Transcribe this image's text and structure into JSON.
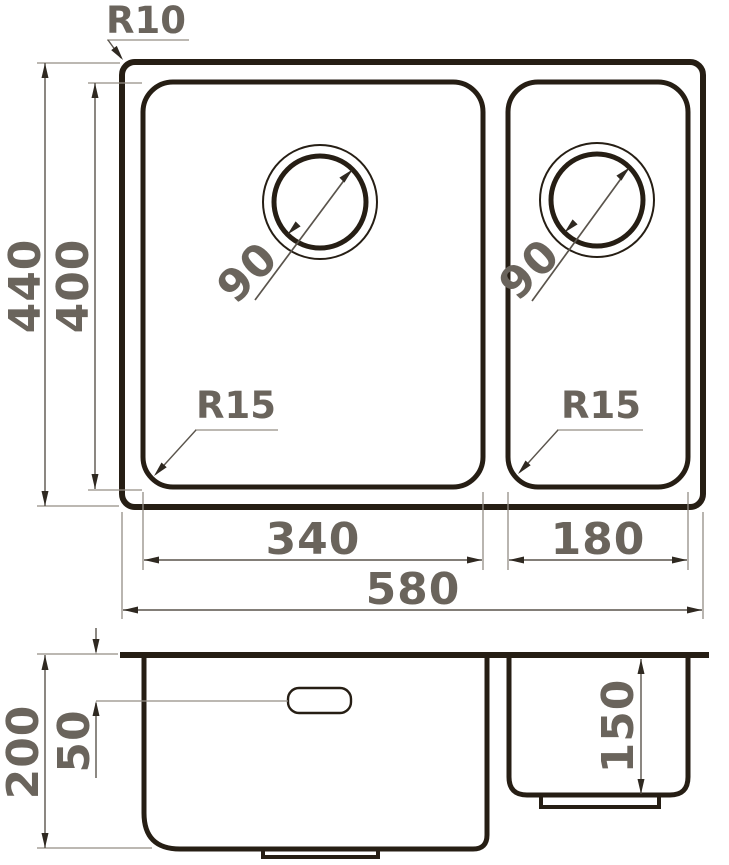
{
  "colors": {
    "outline": "#261e14",
    "thin": "#938d85",
    "dim": "#5a544c",
    "arrow": "#2f2921",
    "text": "#6a645c",
    "bg": "#ffffff"
  },
  "views": {
    "top": {
      "name": "sink-top-view",
      "dims": {
        "overall_width": "580",
        "overall_depth": "440",
        "inner_depth": "400",
        "left_bowl_width": "340",
        "right_bowl_width": "180",
        "outer_corner_radius": "R10",
        "left_bowl_corner_radius": "R15",
        "right_bowl_corner_radius": "R15",
        "left_drain_diameter": "90",
        "right_drain_diameter": "90"
      }
    },
    "section": {
      "name": "sink-section-view",
      "dims": {
        "overall_height": "200",
        "overflow_offset": "50",
        "right_bowl_depth": "150"
      }
    }
  }
}
